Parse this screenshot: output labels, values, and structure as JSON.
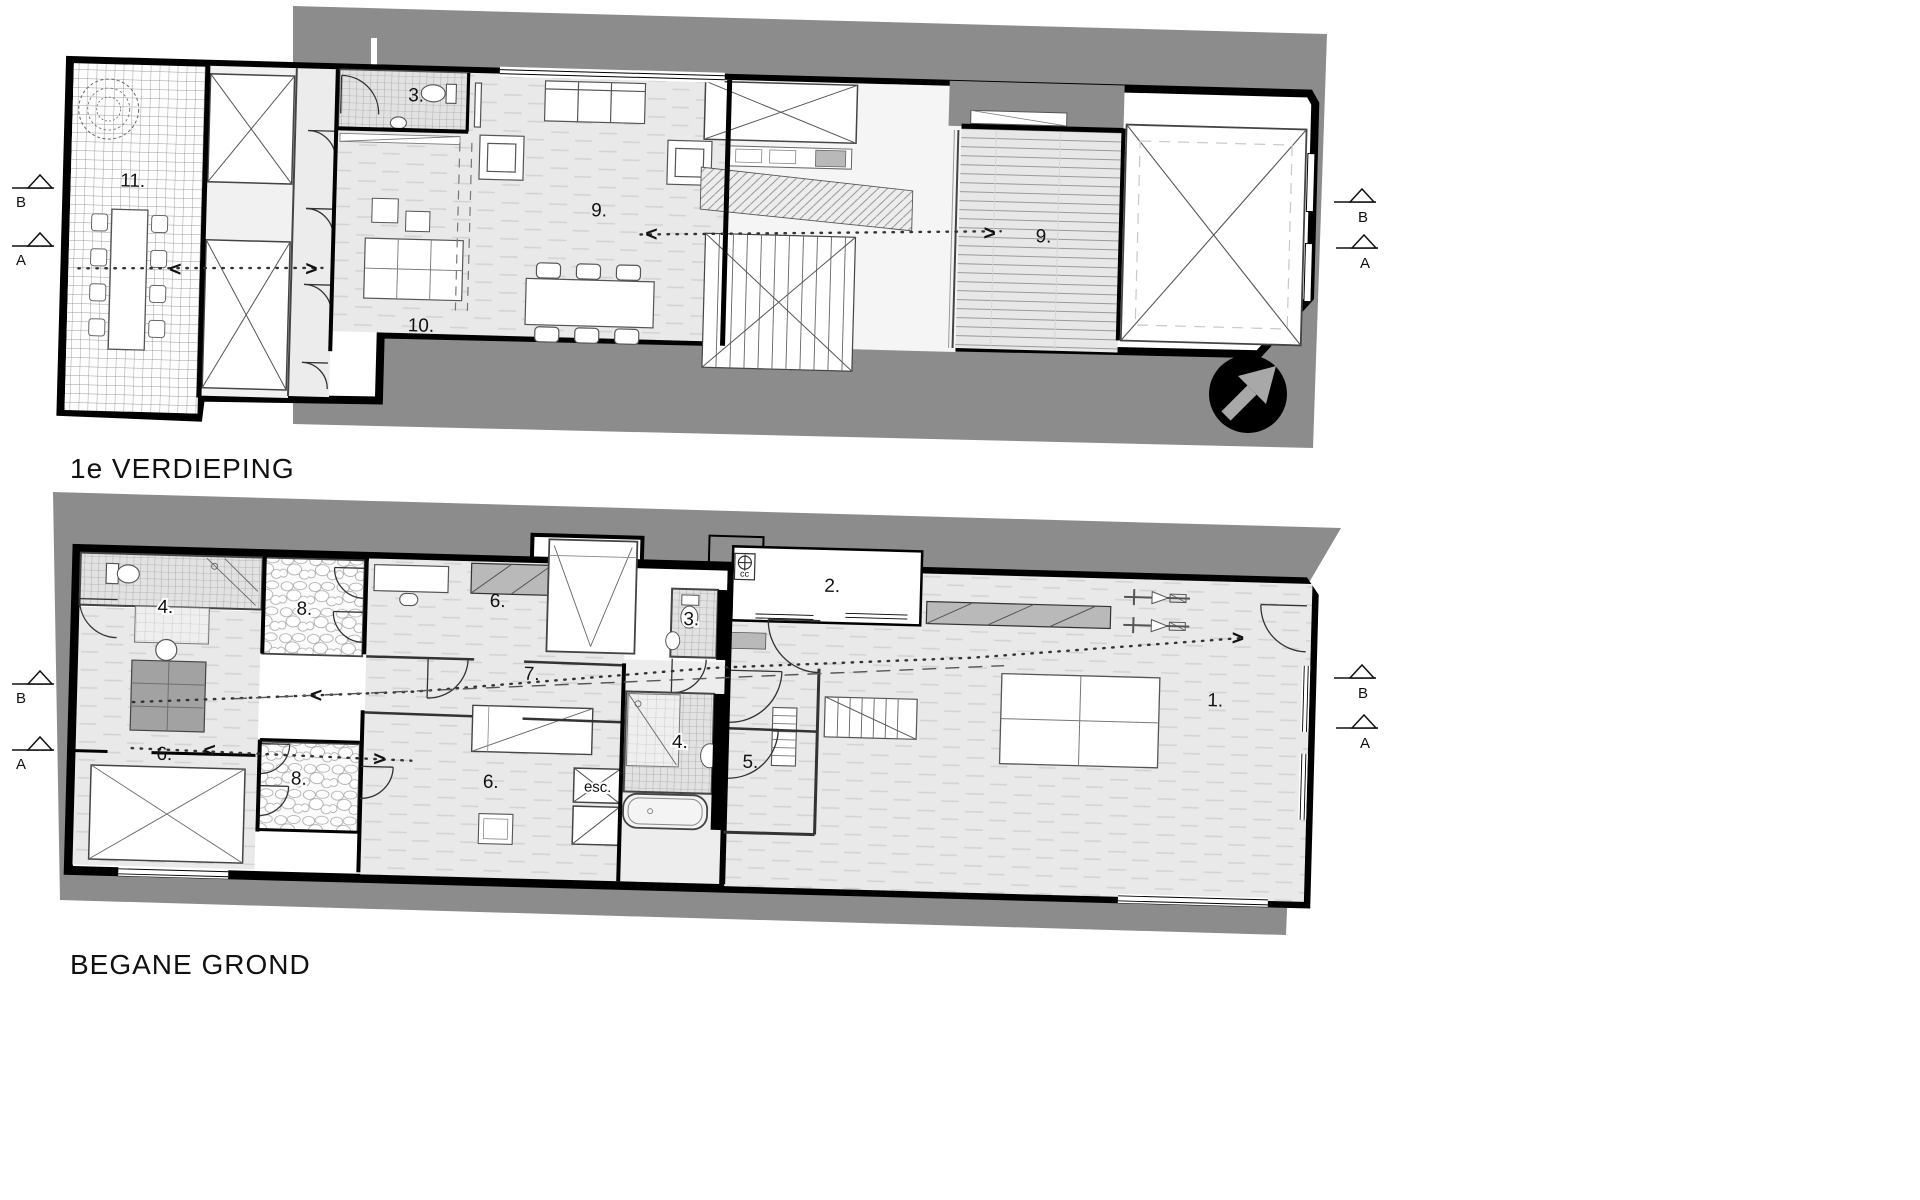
{
  "page": {
    "background": "#ffffff",
    "drawing_type": "architectural floor plans"
  },
  "colors": {
    "site_gray": "#8c8c8c",
    "wall": "#000000",
    "floor": "#e9e9e9",
    "label": "#111111"
  },
  "north_arrow": {
    "name": "northeast-arrow",
    "circle_color": "#000000",
    "arrow_color": "#a8a8a8"
  },
  "circulation": {
    "left_arrow": "<",
    "right_arrow": ">"
  },
  "plans": [
    {
      "id": "first-floor",
      "title": "1e VERDIEPING",
      "rooms": [
        {
          "label": "11."
        },
        {
          "label": "3."
        },
        {
          "label": "9."
        },
        {
          "label": "10."
        },
        {
          "label": "9."
        }
      ],
      "markers": {
        "left": [
          {
            "label": "B"
          },
          {
            "label": "A"
          }
        ],
        "right": [
          {
            "label": "B"
          },
          {
            "label": "A"
          }
        ]
      }
    },
    {
      "id": "ground-floor",
      "title": "BEGANE GROND",
      "rooms": [
        {
          "label": "4."
        },
        {
          "label": "8."
        },
        {
          "label": "6."
        },
        {
          "label": "3."
        },
        {
          "label": "2."
        },
        {
          "label": "7."
        },
        {
          "label": "6."
        },
        {
          "label": "8."
        },
        {
          "label": "6."
        },
        {
          "label": "esc."
        },
        {
          "label": "4."
        },
        {
          "label": "5."
        },
        {
          "label": "1."
        }
      ],
      "utility_label": "cc",
      "markers": {
        "left": [
          {
            "label": "B"
          },
          {
            "label": "A"
          }
        ],
        "right": [
          {
            "label": "B"
          },
          {
            "label": "A"
          }
        ]
      }
    }
  ]
}
